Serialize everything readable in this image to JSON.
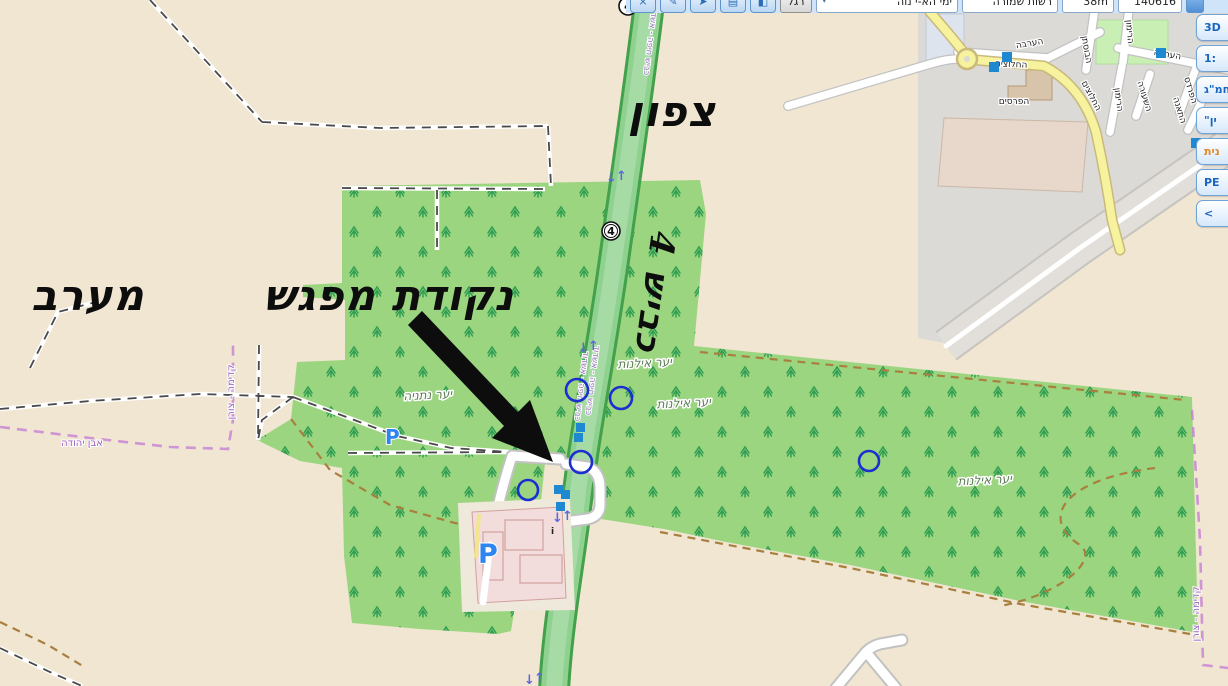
{
  "toolbar": {
    "buttons": [
      {
        "name": "close-icon",
        "glyph": "×"
      },
      {
        "name": "pencil-icon",
        "glyph": "✎"
      },
      {
        "name": "pin-icon",
        "glyph": "➤"
      },
      {
        "name": "save-icon",
        "glyph": "▤"
      },
      {
        "name": "erase-icon",
        "glyph": "◧"
      }
    ],
    "foot_button_label": "רגל",
    "dropdown_arrow": "▾",
    "layer_dropdown_value": "ימי הא-י נוה",
    "status_value": "רשות שמורה",
    "elevation_value": "38m",
    "coordinate_value": "140616"
  },
  "side_panel": {
    "buttons": [
      {
        "label": "3D"
      },
      {
        "label": "1:"
      },
      {
        "label": "חמ\"ג"
      },
      {
        "label": "\"ין"
      },
      {
        "label": "נית",
        "highlighted": true
      },
      {
        "label": "PE"
      },
      {
        "label": "<"
      }
    ]
  },
  "annotations": {
    "north": "צפון",
    "west": "מערב",
    "meeting_point": "נקודת מפגש",
    "road": "כביש 4"
  },
  "map": {
    "road_shield": "4",
    "parking_label": "P",
    "info_label": "i",
    "arrow_up": "↑",
    "arrow_down": "↓",
    "forest_labels": [
      {
        "text": "יער נתניה"
      },
      {
        "text": "יער אילנות"
      },
      {
        "text": "יער אילנות"
      },
      {
        "text": "יער אילנות"
      }
    ],
    "street_labels": [
      {
        "text": "הערבה"
      },
      {
        "text": "החלוצים"
      },
      {
        "text": "הבוסתן"
      },
      {
        "text": "הרימון"
      },
      {
        "text": "הרימון"
      },
      {
        "text": "הערבה"
      },
      {
        "text": "השעורה"
      },
      {
        "text": "הפרדס"
      },
      {
        "text": "התאנה"
      },
      {
        "text": "החלוצים"
      },
      {
        "text": "הפרסים"
      }
    ],
    "boundary_labels": [
      {
        "text": "אבן יהודה"
      },
      {
        "text": "קדימה - צורן"
      },
      {
        "text": "קדימה - צורן"
      }
    ],
    "route_labels": [
      {
        "text": "כביש חיפה - אשדוד"
      },
      {
        "text": "כביש חיפה - אשדוד"
      },
      {
        "text": "כביש חיפה - אשדוד"
      }
    ]
  },
  "colors": {
    "bg": "#f0e6d2",
    "forest": "#9cd57f",
    "tree": "#2f9e52",
    "road_fill": "#8fd18f",
    "road_casing": "#43a04b",
    "road_center": "#a6dba6",
    "urban": "#dbdad7",
    "band": "#e2dfda",
    "yellow_road": "#f7f29e",
    "yellow_casing": "#c9b97a",
    "road_gray_casing": "#c2c2c2",
    "park": "#c9efb4",
    "building_tan": "#d8c4aa",
    "building_pale": "#e7d8cb",
    "building_blue": "#dde4ed",
    "pink_area": "#f3dcdc",
    "pink_outline": "#d2a0a0",
    "track": "#4a4a4a",
    "path_brown": "#a97f3f",
    "boundary": "#c77fd4",
    "marker_blue": "#1b2fd0",
    "square_blue": "#1e88d0",
    "arrow_blue": "#5b68dd",
    "parking": "#2f85f0",
    "label_forest": "#5e7c55",
    "label_boundary": "#9c5fc0",
    "label_route": "#8a6ab0",
    "annotation": "#0d0d0d",
    "toolbar_bg": "#cfe4f8",
    "button_border": "#5f93c9",
    "panel_border": "#6fa3d8",
    "panel_text": "#1866c0",
    "panel_highlight": "#e5891e"
  }
}
